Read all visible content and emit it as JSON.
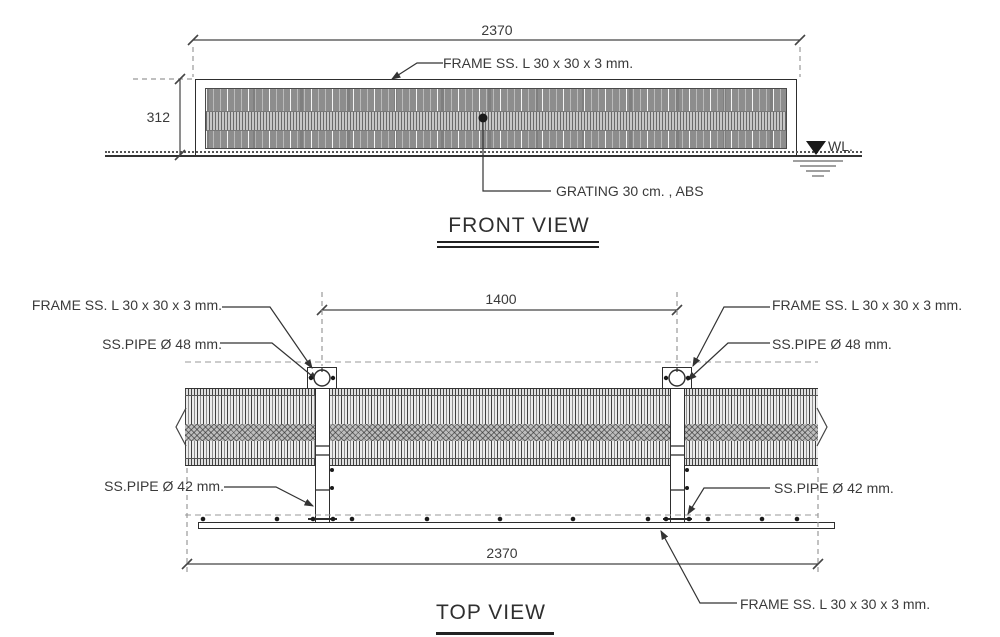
{
  "drawing": {
    "front_view": {
      "title": "FRONT VIEW",
      "width_dim": "2370",
      "height_dim": "312",
      "frame_label": "FRAME SS. L 30 x 30 x 3 mm.",
      "grating_label": "GRATING 30 cm. , ABS",
      "water_level_label": "WL."
    },
    "top_view": {
      "title": "TOP VIEW",
      "pipe_spacing_dim": "1400",
      "width_dim": "2370",
      "frame_label_left": "FRAME SS. L 30 x 30 x 3 mm.",
      "frame_label_right": "FRAME SS. L 30 x 30 x 3 mm.",
      "frame_label_bottom": "FRAME SS. L 30 x 30 x 3 mm.",
      "pipe48_label_left": "SS.PIPE Ø 48 mm.",
      "pipe48_label_right": "SS.PIPE Ø 48 mm.",
      "pipe42_label_left": "SS.PIPE Ø 42 mm.",
      "pipe42_label_right": "SS.PIPE Ø 42 mm."
    },
    "colors": {
      "line": "#333333",
      "dim_line": "#444444",
      "grating_dark": "#8d8d8d",
      "background": "#ffffff"
    }
  }
}
